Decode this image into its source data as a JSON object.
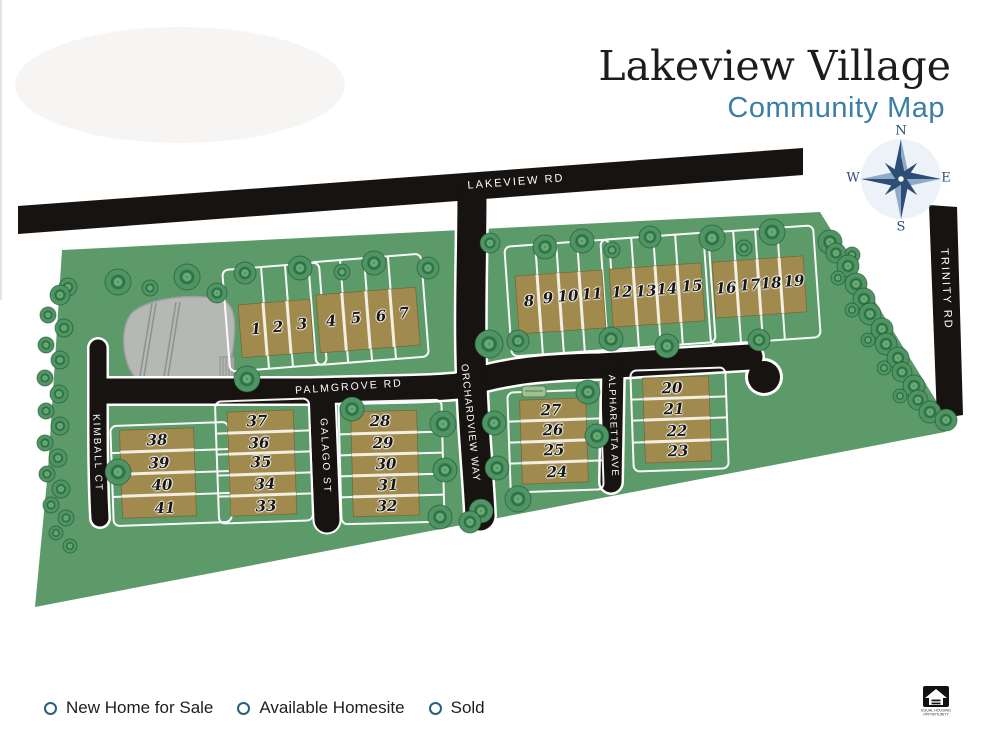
{
  "title": "Lakeview Village",
  "subtitle": "Community Map",
  "compass": {
    "n": "N",
    "e": "E",
    "s": "S",
    "w": "W"
  },
  "roads": {
    "lakeview": "LAKEVIEW RD",
    "trinity": "TRINITY RD",
    "palmgrove": "PALMGROVE RD",
    "orchardview": "ORCHARDVIEW WAY",
    "kimball": "KIMBALL CT",
    "galago": "GALAGO ST",
    "alpharetta": "ALPHARETTA AVE"
  },
  "lots": [
    "1",
    "2",
    "3",
    "4",
    "5",
    "6",
    "7",
    "8",
    "9",
    "10",
    "11",
    "12",
    "13",
    "14",
    "15",
    "16",
    "17",
    "18",
    "19",
    "20",
    "21",
    "22",
    "23",
    "24",
    "25",
    "26",
    "27",
    "28",
    "29",
    "30",
    "31",
    "32",
    "33",
    "34",
    "35",
    "36",
    "37",
    "38",
    "39",
    "40",
    "41"
  ],
  "legend": {
    "items": [
      {
        "label": "New Home for Sale"
      },
      {
        "label": "Available Homesite"
      },
      {
        "label": "Sold"
      }
    ]
  },
  "footer_logo": {
    "line1": "EQUAL HOUSING",
    "line2": "OPPORTUNITY"
  },
  "colors": {
    "land": "#5c9a6a",
    "road": "#171310",
    "building": "#a18a4d",
    "subtitle_teal": "#3b7ea6",
    "compass_navy": "#2c4d76",
    "legend_ring": "#2a5f78"
  }
}
